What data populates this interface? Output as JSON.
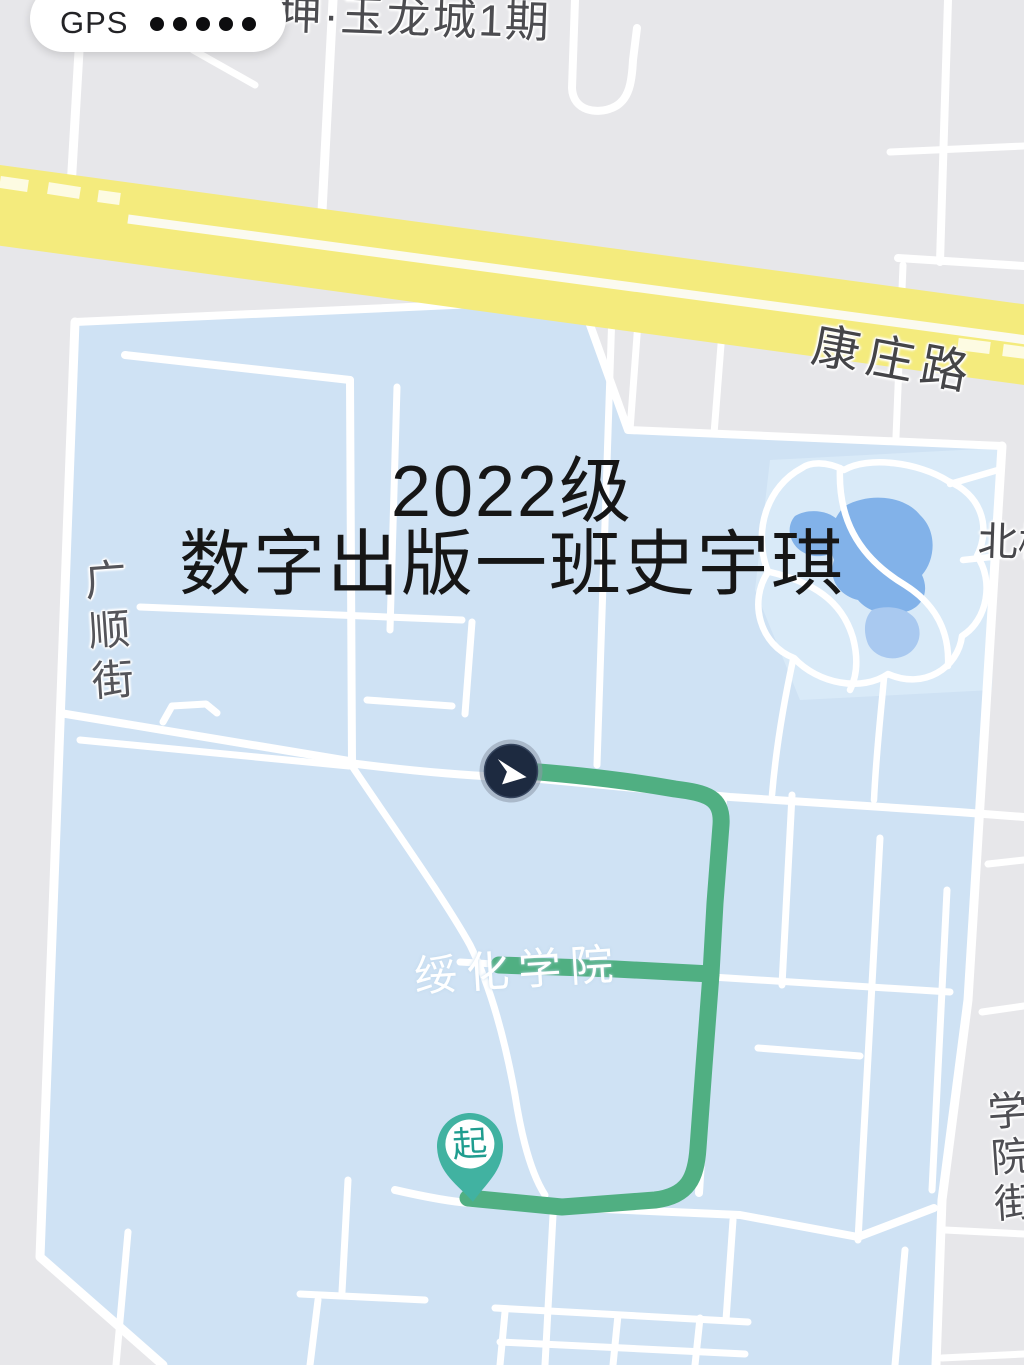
{
  "status_bar": {
    "gps_label": "GPS",
    "signal_dots": 5
  },
  "map": {
    "poi_labels": {
      "top_estate": "坤·玉龙城1期",
      "highway": "康庄路",
      "street_left": "广顺街",
      "street_right": "学院街",
      "campus": "绥化学院",
      "north_partial": "北校"
    },
    "watermark": {
      "line1": "2022级",
      "line2": "数字出版一班史宇琪"
    },
    "route": {
      "start_marker_label": "起"
    },
    "colors": {
      "background_gray": "#e7e7ea",
      "campus_blue": "#cfe2f4",
      "park_blue": "#d9eaf8",
      "pond_blue": "#82b2e9",
      "pond_blue_light": "#a9c9f0",
      "road_white": "#ffffff",
      "highway_yellow": "#f4eb7d",
      "highway_centerline": "#fbfaf0",
      "route_green": "#50af82",
      "pin_teal": "#41b2a1",
      "pin_glyph_teal": "#1f9d8f",
      "marker_navy": "#1d2a40"
    }
  }
}
